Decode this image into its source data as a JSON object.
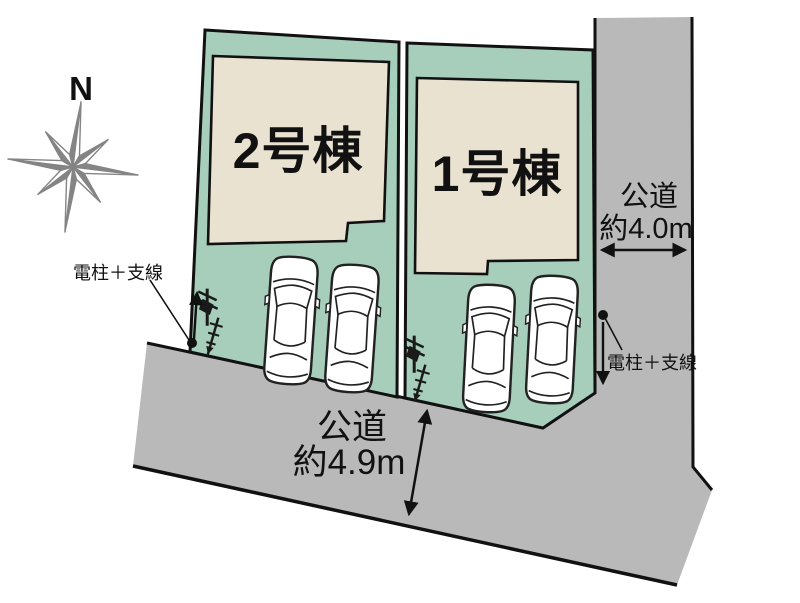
{
  "colors": {
    "lot_fill": "#a6cebb",
    "building_fill": "#eae2d0",
    "road_fill": "#b9b9b9",
    "outline": "#111111",
    "compass_gray": "#848484"
  },
  "compass": {
    "north_label": "N"
  },
  "buildings": [
    {
      "label": "2号棟"
    },
    {
      "label": "1号棟"
    }
  ],
  "roads": [
    {
      "name": "right-road",
      "line1": "公道",
      "line2": "約4.0m"
    },
    {
      "name": "bottom-road",
      "line1": "公道",
      "line2": "約4.9m"
    }
  ],
  "pole_labels": {
    "left": "電柱＋支線",
    "right": "電柱＋支線"
  }
}
